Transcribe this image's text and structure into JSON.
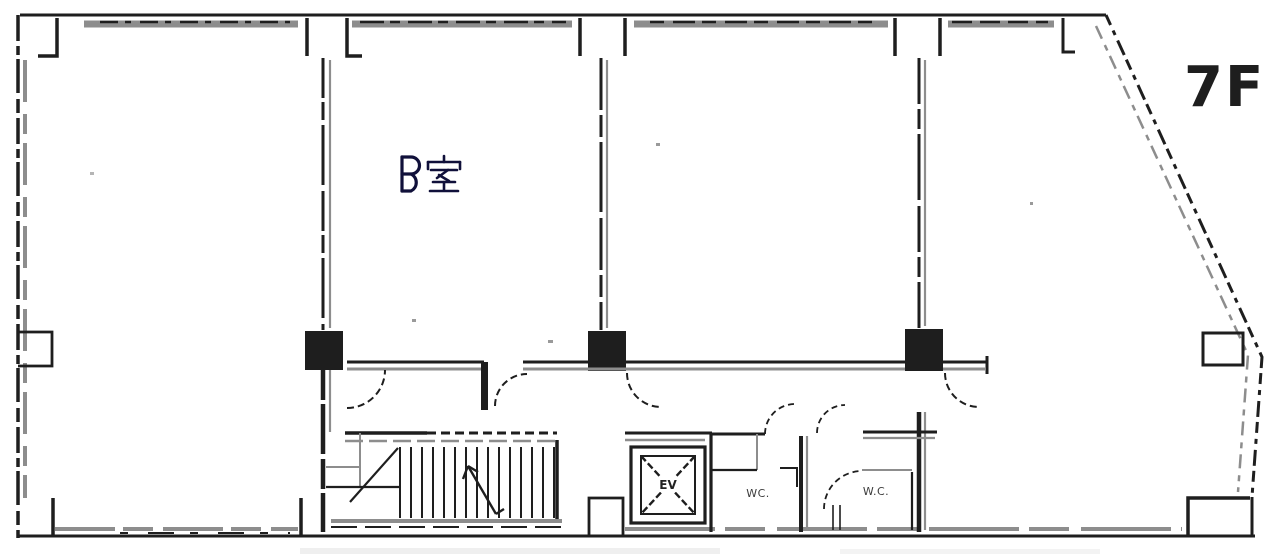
{
  "floor": {
    "label": "7F"
  },
  "rooms": {
    "room_b": {
      "label": "B室"
    },
    "elevator": {
      "label": "EV"
    },
    "wc_left": {
      "label": "WC."
    },
    "wc_right": {
      "label": "W.C."
    }
  },
  "colors": {
    "ink": "#1e1e1e",
    "wall_gray": "#8d8d8d",
    "paper": "#ffffff",
    "label_navy": "#10103a"
  }
}
